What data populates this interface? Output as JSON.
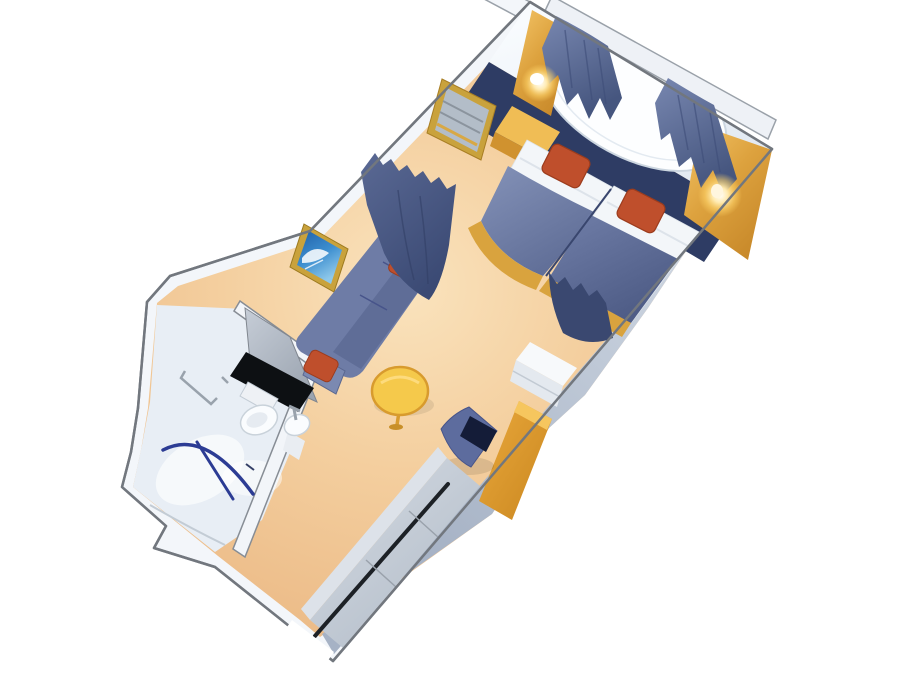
{
  "canvas": {
    "width": 900,
    "height": 700
  },
  "scene": {
    "name": "cruise-ship-stateroom-floor-plan",
    "view": "3d-isometric-cutaway-rendering",
    "background": "#ffffff"
  },
  "palette": {
    "background": "#ffffff",
    "wall_white": "#f3f6fa",
    "wall_edge": "#72777e",
    "pelmet": "#eef1f6",
    "carpet": "#efc08d",
    "carpet_light": "#fae3bd",
    "right_wall_light": "#d9e0ea",
    "right_wall_dark": "#a6b2c5",
    "navy_headboard": "#2e3c64",
    "window_white": "#fdfeff",
    "window_rim": "#ccd6e0",
    "curtain_light": "#7887b0",
    "curtain_dark": "#46567f",
    "gold_top": "#f0bd55",
    "gold_front": "#d0922f",
    "gold_base": "#d9a33e",
    "lamp_glow": "#ffd469",
    "pillow_white": "#f3f6f9",
    "bed_cover": "#7684ad",
    "bed_cover_dark": "#5e6c96",
    "bed_seam": "#39466e",
    "cushion_red": "#bf4f2c",
    "cushion_red_dark": "#9c3c1d",
    "divider_right": "#3a4870",
    "sofa_blue": "#6e7ca6",
    "sofa_seat": "#5f6d97",
    "sofa_ridge": "#8290b6",
    "sofa_arm": "#7b89b1",
    "frame_gold": "#c9a23c",
    "art_blue": "#2f7fc4",
    "mirror_glass": "#b3bdc8",
    "table_yellow": "#f5c94b",
    "table_rim": "#d89b2e",
    "chair_back": "#5d6c9e",
    "chair_seat": "#141c38",
    "cabinet_top": "#f7f9fb",
    "cabinet_front": "#e4e9ef",
    "closet_top": "#dde2e9",
    "slot_dark": "#1d2126",
    "seam_gray": "#9aa2ac",
    "bath_floor": "#e8eef5",
    "bath_wall": "#f2f5f9",
    "fixture_white": "#fafcfe",
    "fixture_edge": "#c9d2da",
    "counter_black": "#0d1013",
    "shower_rod": "#2c3c94",
    "chrome": "#99a2ac",
    "door_gap": "#ffffff"
  },
  "objects": {
    "bedroom": [
      "twin-bed-left",
      "twin-bed-right",
      "white-pillows",
      "red-throw-cushions",
      "headboard-panel",
      "picture-window",
      "window-curtains",
      "gold-wall-panels",
      "wall-lamps",
      "nightstand-dresser",
      "vanity-mirror"
    ],
    "sitting_area": [
      "sofa",
      "red-sofa-pillows",
      "wall-art",
      "round-coffee-table",
      "room-divider-curtains"
    ],
    "desk_area": [
      "vanity-desk",
      "desk-chair",
      "drawer-cabinet"
    ],
    "bathroom": [
      "shower",
      "shower-curtain-rod",
      "toilet",
      "pedestal-sink",
      "vanity-counter",
      "towel-bar",
      "bathroom-door"
    ],
    "entry": [
      "wardrobe-closet",
      "corridor",
      "entrance-door-opening"
    ]
  }
}
